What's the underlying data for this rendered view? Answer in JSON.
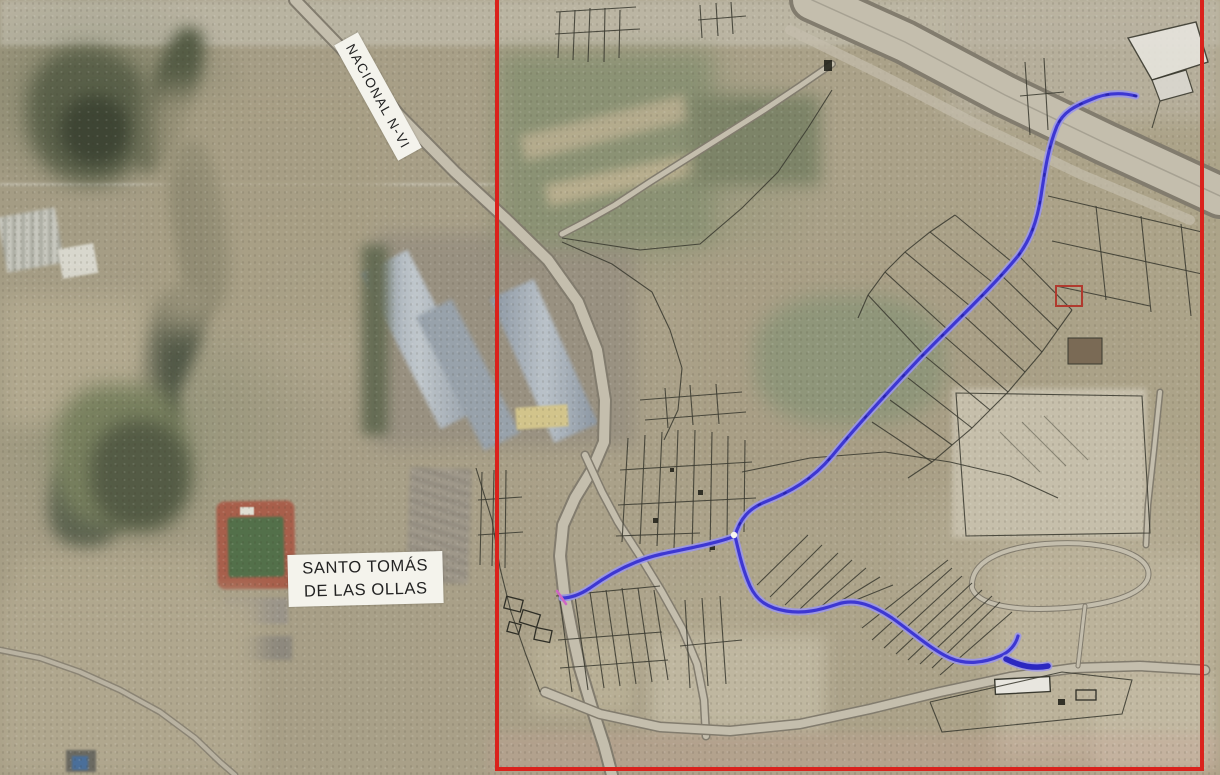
{
  "map": {
    "road_label": "NACIONAL N-VI",
    "place_label": {
      "line1": "SANTO TOMÁS",
      "line2": "DE LAS OLLAS"
    },
    "colors": {
      "study_area_border": "#da221c",
      "route_core": "#3d37d2",
      "route_halo": "#9b97e8",
      "route_end": "#2b28c0",
      "parcel_line": "#3b3b31",
      "label_bg": "#f4f3ec",
      "label_text": "#222222",
      "marker_pink": "#cf66c4"
    }
  }
}
